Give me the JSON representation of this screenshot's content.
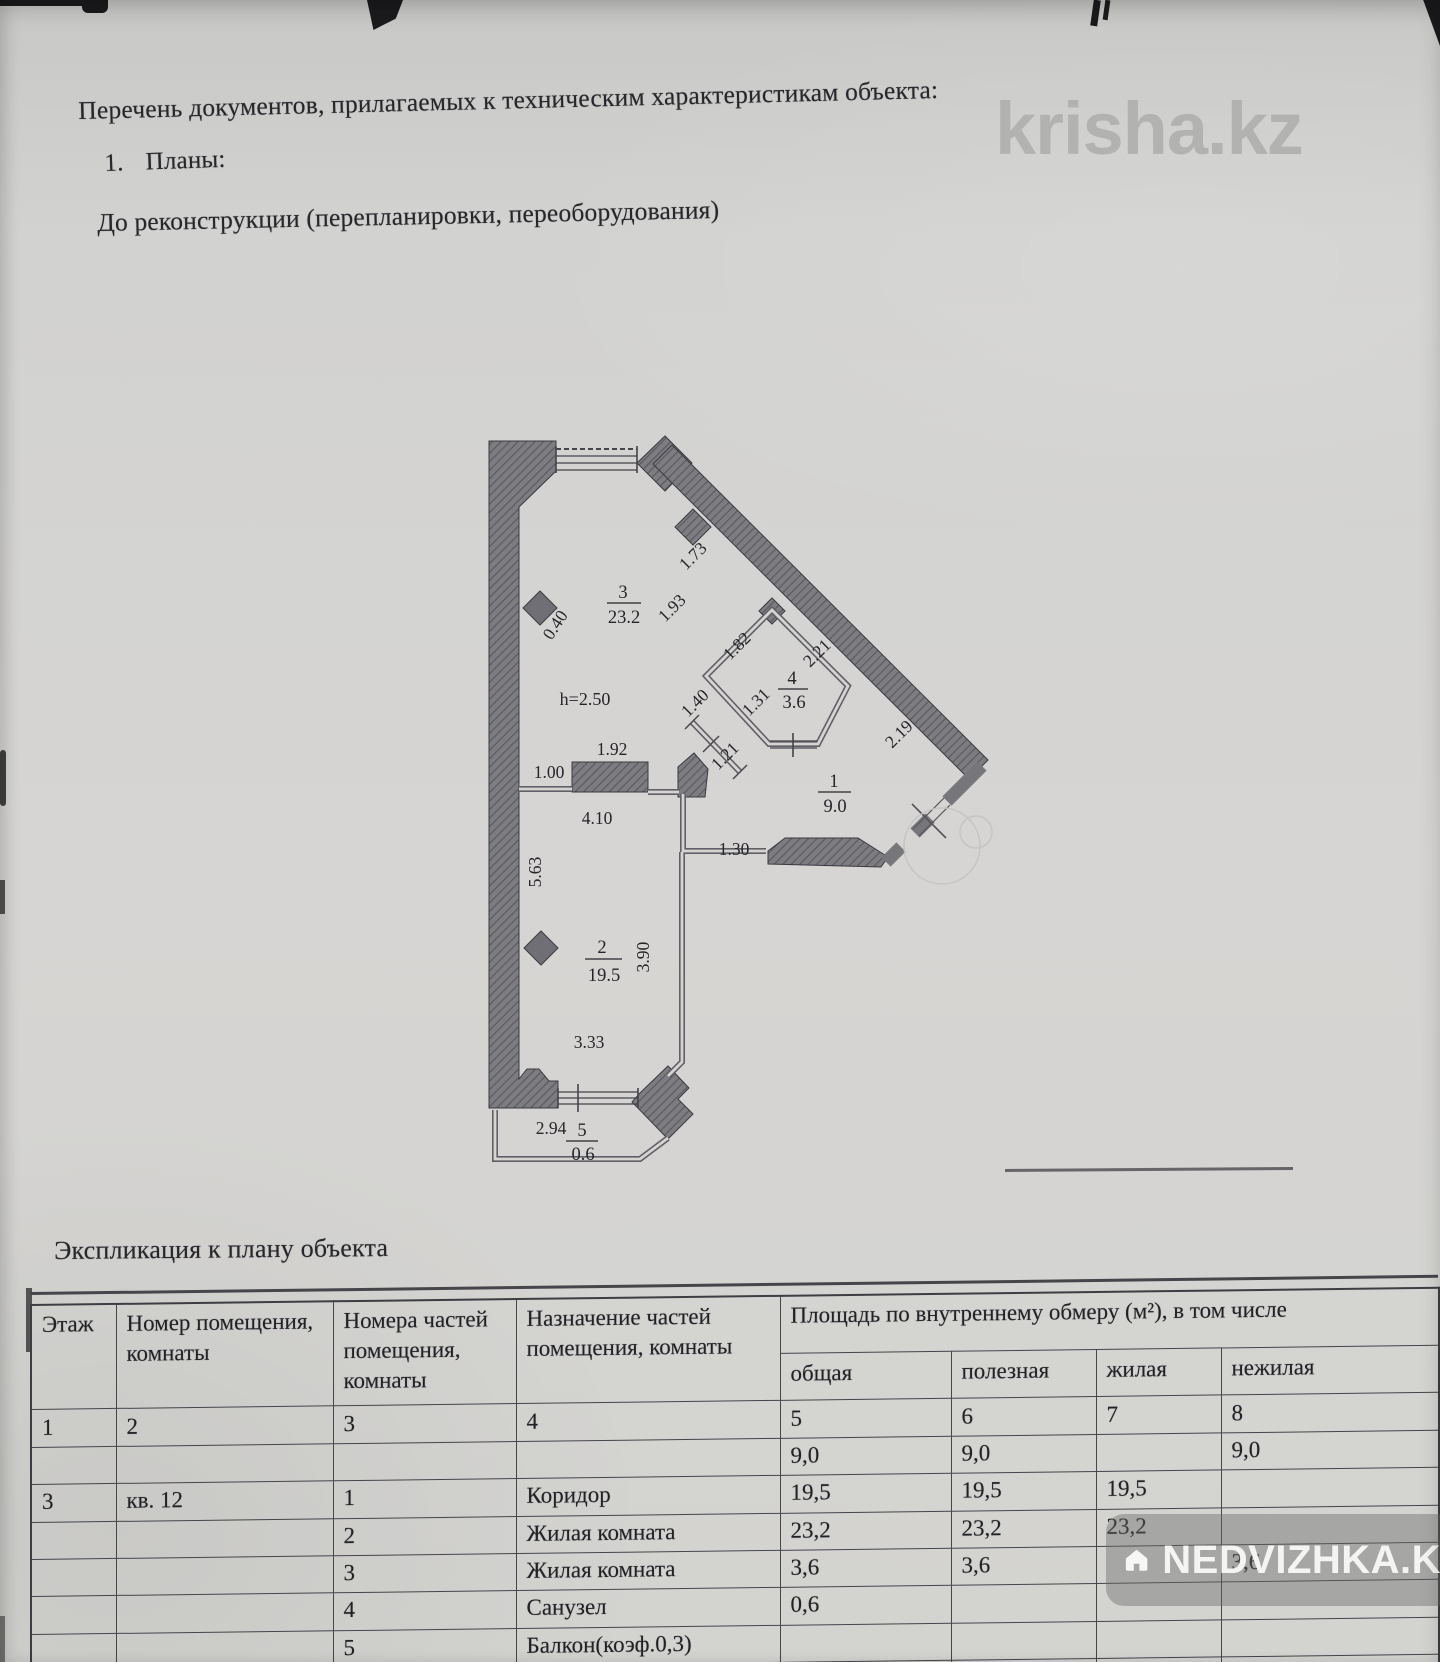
{
  "doc": {
    "header": "Перечень документов, прилагаемых к техническим характеристикам объекта:",
    "list_item_number": "1.",
    "list_item": "Планы:",
    "subtitle": "До реконструкции (перепланировки, переоборудования)",
    "explication_title": "Экспликация к плану объекта"
  },
  "watermarks": {
    "krisha": "krisha.kz",
    "nedvizhka": "NEDVIZHKA.KZ"
  },
  "floor_plan": {
    "height_note": "h=2.50",
    "rooms": {
      "r1": {
        "num": "1",
        "area": "9.0"
      },
      "r2": {
        "num": "2",
        "area": "19.5"
      },
      "r3": {
        "num": "3",
        "area": "23.2"
      },
      "r4": {
        "num": "4",
        "area": "3.6"
      },
      "r5": {
        "num": "5",
        "area": "0.6"
      }
    },
    "dims": {
      "v040": "0.40",
      "v173": "1.73",
      "v193": "1.93",
      "v182": "1.82",
      "v221": "2.21",
      "v131": "1.31",
      "v140": "1.40",
      "v121": "1.21",
      "v219": "2.19",
      "v192": "1.92",
      "v100": "1.00",
      "v410": "4.10",
      "v130": "1.30",
      "v563": "5.63",
      "v390": "3.90",
      "v333": "3.33",
      "v294": "2.94"
    }
  },
  "table": {
    "col_headers": [
      "Этаж",
      "Номер помещения, комнаты",
      "Номера частей помещения, комнаты",
      "Назначение частей помещения, комнаты"
    ],
    "area_header": "Площадь по внутреннему обмеру (м²), в том числе",
    "area_subheaders": [
      "общая",
      "полезная",
      "жилая",
      "нежилая"
    ],
    "numbering_row": [
      "1",
      "2",
      "3",
      "4",
      "5",
      "6",
      "7",
      "8"
    ],
    "rows": [
      [
        "",
        "",
        "",
        "",
        "9,0",
        "9,0",
        "",
        "9,0"
      ],
      [
        "3",
        "кв. 12",
        "1",
        "Коридор",
        "19,5",
        "19,5",
        "19,5",
        ""
      ],
      [
        "",
        "",
        "2",
        "Жилая комната",
        "23,2",
        "23,2",
        "23,2",
        ""
      ],
      [
        "",
        "",
        "3",
        "Жилая комната",
        "3,6",
        "3,6",
        "",
        "3,6"
      ],
      [
        "",
        "",
        "4",
        "Санузел",
        "0,6",
        "",
        "",
        ""
      ],
      [
        "",
        "",
        "5",
        "Балкон(коэф.0,3)",
        "",
        "",
        "",
        ""
      ],
      [
        "",
        "",
        "",
        "",
        "",
        "",
        "",
        ""
      ]
    ]
  }
}
